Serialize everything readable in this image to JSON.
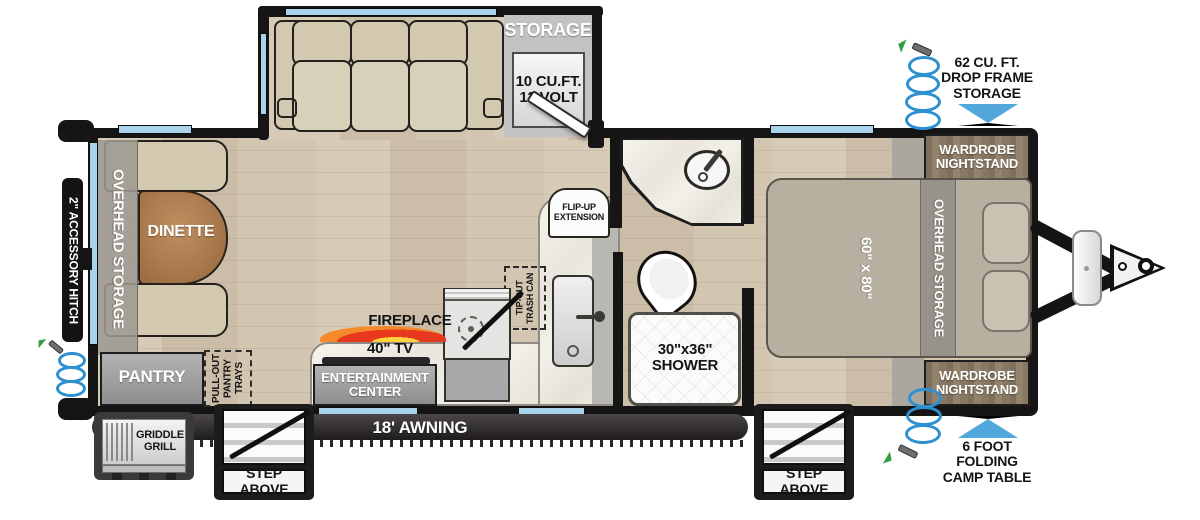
{
  "slideout": {
    "storage": "STORAGE",
    "fridge": [
      "10 CU.FT.",
      "12 VOLT"
    ]
  },
  "living": {
    "overhead": "OVERHEAD STORAGE",
    "dinette": "DINETTE",
    "pantry": "PANTRY",
    "pullout": [
      "PULL-OUT",
      "PANTRY",
      "TRAYS"
    ],
    "fireplace": "FIREPLACE",
    "tv": "40\" TV",
    "entertainment": [
      "ENTERTAINMENT",
      "CENTER"
    ]
  },
  "kitchen": {
    "flipup": [
      "FLIP-UP",
      "EXTENSION"
    ],
    "trash": [
      "TIP-OUT",
      "TRASH CAN"
    ]
  },
  "bath": {
    "shower": [
      "30\"x36\"",
      "SHOWER"
    ]
  },
  "bedroom": {
    "bed": "60\" x 80\"",
    "overhead": "OVERHEAD STORAGE",
    "wardrobe1": [
      "WARDROBE",
      "NIGHTSTAND"
    ],
    "wardrobe2": [
      "WARDROBE",
      "NIGHTSTAND"
    ]
  },
  "exterior": {
    "accessory_hitch": "2\" ACCESSORY HITCH",
    "griddle": [
      "GRIDDLE",
      "GRILL"
    ],
    "awning": "18' AWNING",
    "step1": "STEP ABOVE",
    "step2": "STEP ABOVE",
    "dropframe": [
      "62 CU. FT.",
      "DROP FRAME",
      "STORAGE"
    ],
    "camptable": [
      "6 FOOT",
      "FOLDING",
      "CAMP TABLE"
    ]
  },
  "colors": {
    "window": "#a8d3ea",
    "arrow": "#52a7dc",
    "hose": "#2e90d0",
    "wall": "#151515"
  }
}
